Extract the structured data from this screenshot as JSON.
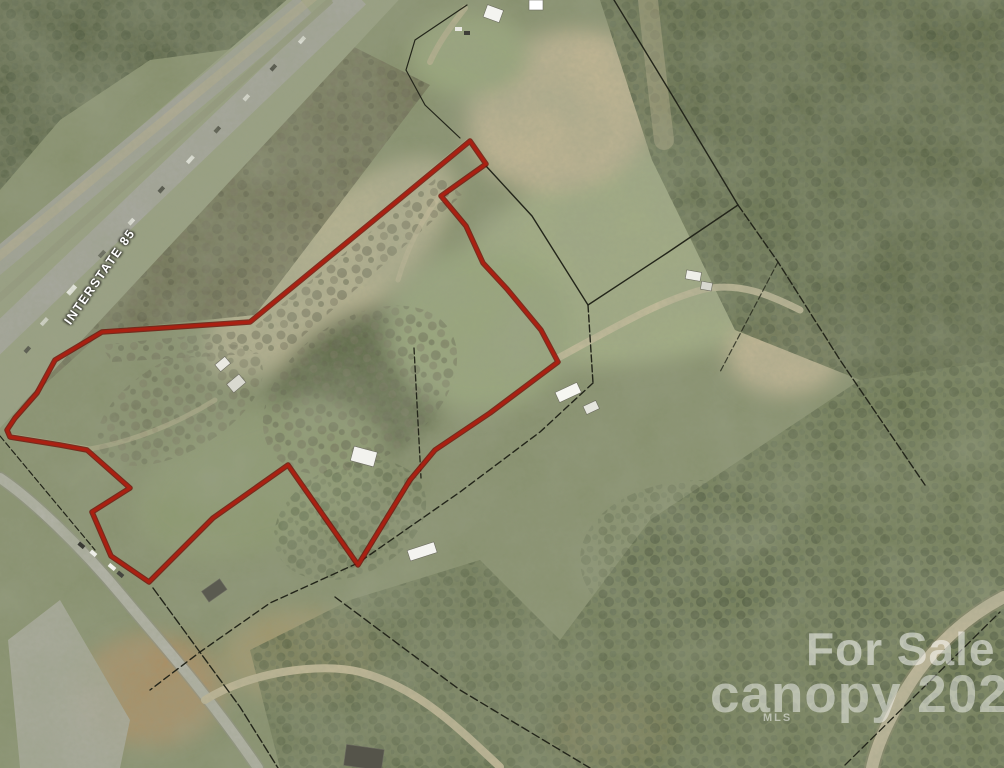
{
  "meta": {
    "width": 1004,
    "height": 768,
    "description": "aerial satellite photo of land parcel for sale beside Interstate 85"
  },
  "labels": {
    "interstate": "INTERSTATE 85"
  },
  "watermark": {
    "line1": "For Sale",
    "line2": "canopy 2022",
    "line3": "MLS",
    "color": "rgba(255,255,255,0.55)"
  },
  "map": {
    "red_boundary": {
      "color": "#ad2012",
      "outline_color": "#6f1208",
      "points": [
        [
          470,
          141
        ],
        [
          486,
          164
        ],
        [
          441,
          196
        ],
        [
          466,
          226
        ],
        [
          483,
          263
        ],
        [
          507,
          289
        ],
        [
          541,
          330
        ],
        [
          558,
          362
        ],
        [
          490,
          413
        ],
        [
          435,
          450
        ],
        [
          410,
          480
        ],
        [
          358,
          565
        ],
        [
          288,
          465
        ],
        [
          213,
          518
        ],
        [
          149,
          582
        ],
        [
          111,
          556
        ],
        [
          92,
          512
        ],
        [
          130,
          488
        ],
        [
          87,
          450
        ],
        [
          60,
          445
        ],
        [
          10,
          437
        ],
        [
          7,
          430
        ],
        [
          15,
          418
        ],
        [
          37,
          393
        ],
        [
          55,
          360
        ],
        [
          102,
          332
        ],
        [
          250,
          322
        ],
        [
          373,
          221
        ]
      ]
    },
    "parcel_lines": {
      "color": "#23251a",
      "polylines": [
        [
          [
            614,
            0
          ],
          [
            672,
            95
          ],
          [
            738,
            205
          ]
        ],
        [
          [
            738,
            205
          ],
          [
            778,
            262
          ],
          [
            840,
            360
          ],
          [
            925,
            485
          ]
        ],
        [
          [
            738,
            205
          ],
          [
            667,
            253
          ],
          [
            588,
            305
          ]
        ],
        [
          [
            486,
            166
          ],
          [
            532,
            216
          ],
          [
            588,
            305
          ]
        ],
        [
          [
            588,
            305
          ],
          [
            593,
            383
          ]
        ],
        [
          [
            593,
            383
          ],
          [
            540,
            432
          ],
          [
            460,
            492
          ],
          [
            358,
            563
          ],
          [
            270,
            603
          ],
          [
            200,
            652
          ],
          [
            150,
            690
          ]
        ],
        [
          [
            153,
            588
          ],
          [
            240,
            707
          ],
          [
            278,
            768
          ]
        ],
        [
          [
            335,
            597
          ],
          [
            460,
            690
          ],
          [
            590,
            768
          ]
        ],
        [
          [
            845,
            765
          ],
          [
            1000,
            612
          ]
        ],
        [
          [
            467,
            5
          ],
          [
            415,
            40
          ],
          [
            406,
            70
          ],
          [
            425,
            105
          ],
          [
            460,
            138
          ]
        ],
        [
          [
            0,
            436
          ],
          [
            60,
            508
          ],
          [
            95,
            550
          ]
        ],
        [
          [
            414,
            348
          ],
          [
            421,
            478
          ]
        ],
        [
          [
            778,
            262
          ],
          [
            758,
            300
          ],
          [
            720,
            372
          ]
        ]
      ]
    }
  }
}
